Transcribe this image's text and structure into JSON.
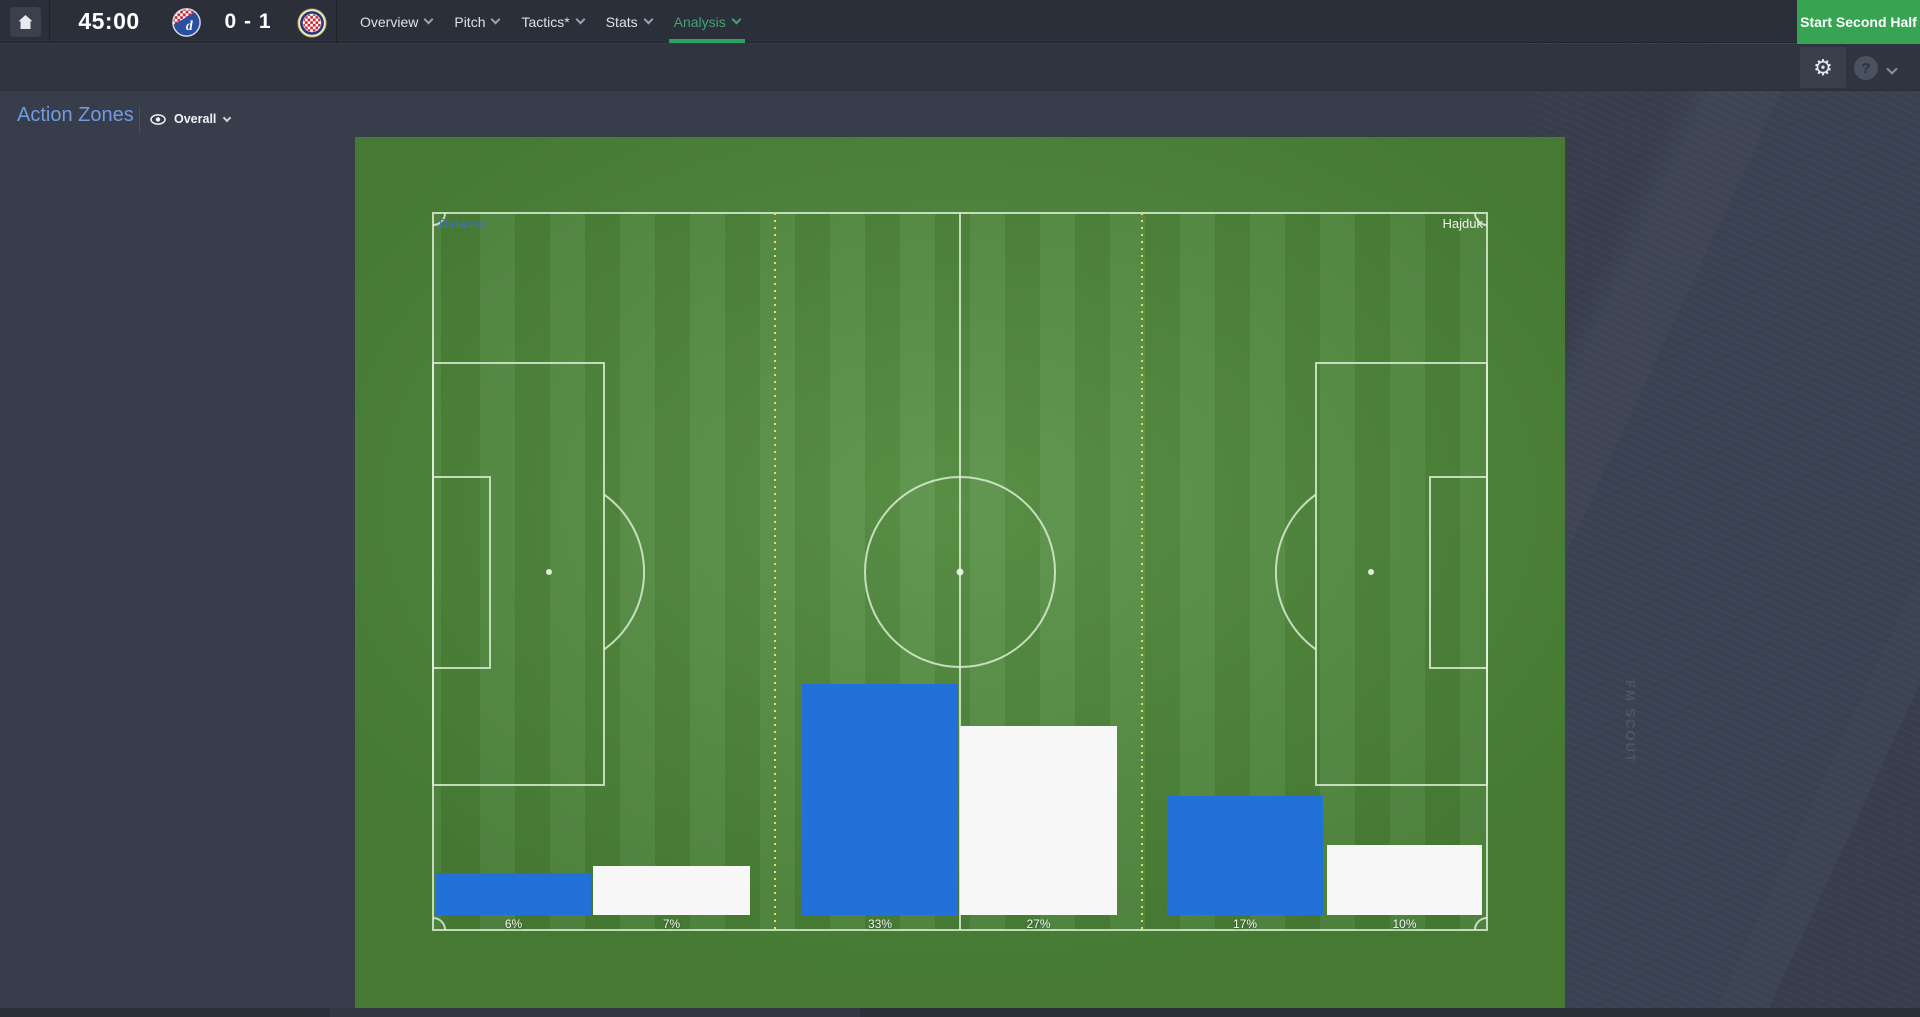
{
  "topbar": {
    "time": "45:00",
    "score": "0 - 1",
    "home_team": "Dinamo",
    "away_team": "Hajduk",
    "tabs": [
      {
        "label": "Overview"
      },
      {
        "label": "Pitch"
      },
      {
        "label": "Tactics*"
      },
      {
        "label": "Stats"
      },
      {
        "label": "Analysis"
      }
    ],
    "active_tab": "Analysis",
    "action_button": "Start Second Half"
  },
  "toolbar": {
    "gear_glyph": "⚙",
    "help_glyph": "?"
  },
  "header": {
    "title": "Action Zones",
    "filter_label": "Overall"
  },
  "pitch": {
    "home_label": "Dinamo",
    "away_label": "Hajduk"
  },
  "watermark": "FM SCOUT",
  "colors": {
    "accent_green": "#2aa35c",
    "analysis_teal": "#46a173",
    "bar_blue": "#2271d9",
    "bar_white": "#f7f7f7",
    "pitch_dark": "#4c8537",
    "pitch_light": "#569044",
    "title_blue": "#6f9ce0"
  },
  "chart_data": {
    "type": "bar",
    "title": "Action Zones",
    "subtitle": "Overall",
    "categories": [
      "Left third",
      "Middle third",
      "Right third"
    ],
    "series": [
      {
        "name": "Dinamo",
        "color": "#2271d9",
        "values": [
          6,
          33,
          17
        ]
      },
      {
        "name": "Hajduk",
        "color": "#f7f7f7",
        "values": [
          7,
          27,
          10
        ]
      }
    ],
    "unit": "%",
    "display_labels": [
      "6%",
      "7%",
      "33%",
      "27%",
      "17%",
      "10%"
    ],
    "ylim": [
      0,
      100
    ],
    "legend_position": "on-pitch-corners",
    "grid": false
  }
}
